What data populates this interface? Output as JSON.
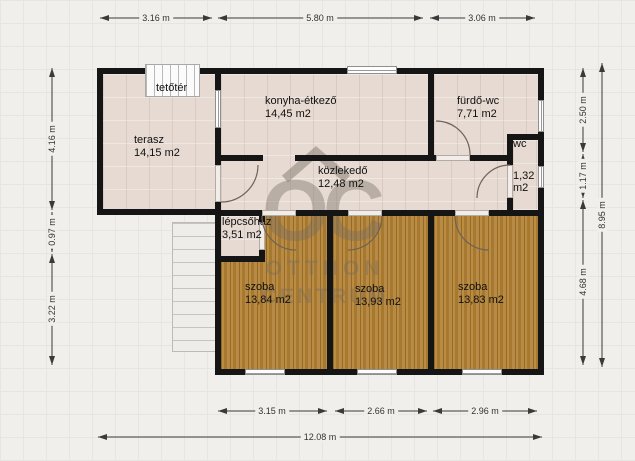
{
  "rooms": [
    {
      "name": "tetőtér",
      "area": ""
    },
    {
      "name": "terasz",
      "area": "14,15 m2"
    },
    {
      "name": "konyha-étkező",
      "area": "14,45 m2"
    },
    {
      "name": "fürdő-wc",
      "area": "7,71 m2"
    },
    {
      "name": "közlekedő",
      "area": "12,48 m2"
    },
    {
      "name": "wc",
      "area": "1,32 m2"
    },
    {
      "name": "lépcsőház",
      "area": "3,51 m2"
    },
    {
      "name": "szoba",
      "area": "13,84 m2"
    },
    {
      "name": "szoba",
      "area": "13,93 m2"
    },
    {
      "name": "szoba",
      "area": "13,83 m2"
    }
  ],
  "dimensions": {
    "top": [
      "3.16 m",
      "5.80 m",
      "3.06 m"
    ],
    "left": [
      "4.16 m",
      "0.97 m",
      "3.22 m"
    ],
    "right": [
      "2.50 m",
      "1.17 m",
      "4.68 m"
    ],
    "right_total": "8.95 m",
    "bottom": [
      "3.15 m",
      "2.66 m",
      "2.96 m"
    ],
    "bottom_total": "12.08 m"
  },
  "watermark": {
    "monogram": "OC",
    "line1": "OTTHON",
    "line2": "CENTRUM"
  },
  "colors": {
    "wall": "#151515",
    "tile_floor": "#e6dad2",
    "wood_floor": "#b08033",
    "background": "#f0efec",
    "dimension_line": "#3a3a3a",
    "watermark": "rgba(118,108,98,0.40)"
  }
}
